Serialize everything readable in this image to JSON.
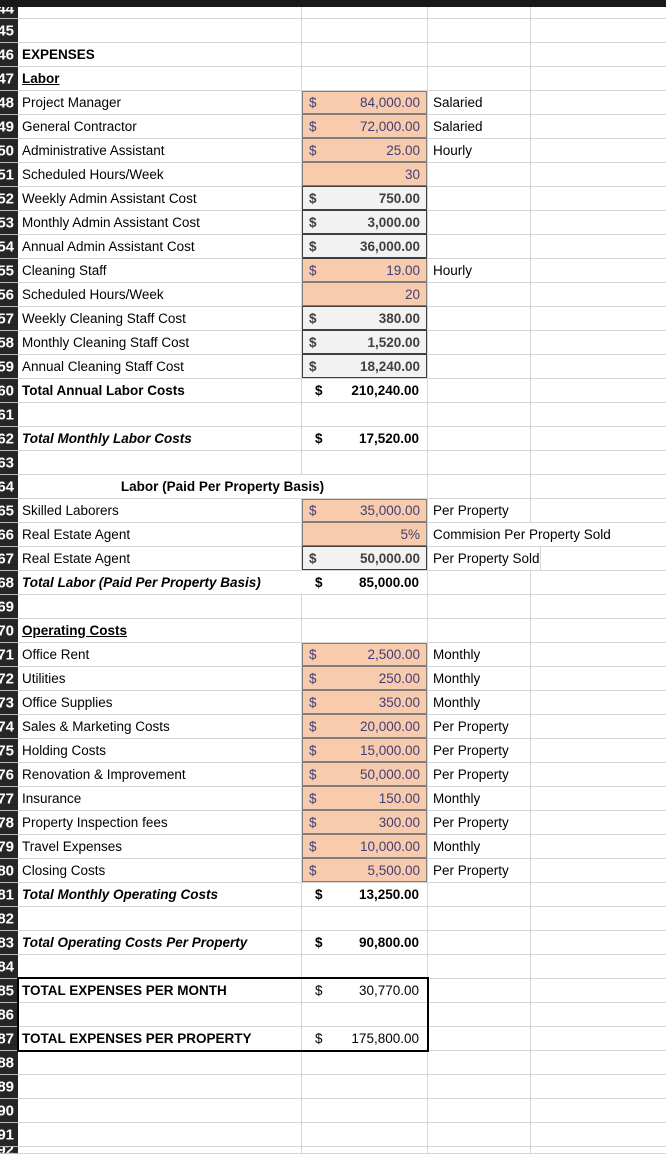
{
  "sheet": {
    "colors": {
      "input_bg": "#F8CBAD",
      "input_text": "#3F3F76",
      "input_border": "#7F7F7F",
      "output_bg": "#F2F2F2",
      "output_text": "#3F3F3F",
      "output_border": "#3F3F3F",
      "grid": "#D6D6D6",
      "header_bg": "#262626",
      "header_text": "#FFFFFF",
      "box_border": "#000000"
    },
    "rows": [
      {
        "n": 44,
        "label": ""
      },
      {
        "n": 45,
        "label": ""
      },
      {
        "n": 46,
        "label": "EXPENSES",
        "label_style": "b"
      },
      {
        "n": 47,
        "label": "Labor",
        "label_style": "bu"
      },
      {
        "n": 48,
        "label": "Project Manager",
        "value": "84,000.00",
        "dollar": "$",
        "value_style": "input",
        "unit": "Salaried"
      },
      {
        "n": 49,
        "label": "General Contractor",
        "value": "72,000.00",
        "dollar": "$",
        "value_style": "input",
        "unit": "Salaried"
      },
      {
        "n": 50,
        "label": "Administrative Assistant",
        "value": "25.00",
        "dollar": "$",
        "value_style": "input",
        "unit": "Hourly"
      },
      {
        "n": 51,
        "label": "Scheduled Hours/Week",
        "value": "30",
        "dollar": "",
        "value_style": "input"
      },
      {
        "n": 52,
        "label": "Weekly Admin Assistant Cost",
        "value": "750.00",
        "dollar": "$",
        "value_style": "output"
      },
      {
        "n": 53,
        "label": "Monthly Admin Assistant Cost",
        "value": "3,000.00",
        "dollar": "$",
        "value_style": "output"
      },
      {
        "n": 54,
        "label": "Annual Admin Assistant Cost",
        "value": "36,000.00",
        "dollar": "$",
        "value_style": "output"
      },
      {
        "n": 55,
        "label": "Cleaning Staff",
        "value": "19.00",
        "dollar": "$",
        "value_style": "input",
        "unit": "Hourly"
      },
      {
        "n": 56,
        "label": "Scheduled Hours/Week",
        "value": "20",
        "dollar": "",
        "value_style": "input"
      },
      {
        "n": 57,
        "label": "Weekly Cleaning Staff Cost",
        "value": "380.00",
        "dollar": "$",
        "value_style": "output"
      },
      {
        "n": 58,
        "label": "Monthly Cleaning Staff Cost",
        "value": "1,520.00",
        "dollar": "$",
        "value_style": "output"
      },
      {
        "n": 59,
        "label": "Annual Cleaning Staff Cost",
        "value": "18,240.00",
        "dollar": "$",
        "value_style": "output"
      },
      {
        "n": 60,
        "label": "Total Annual Labor Costs",
        "label_style": "b",
        "value": "210,240.00",
        "dollar": "$",
        "value_style": "total"
      },
      {
        "n": 61,
        "label": ""
      },
      {
        "n": 62,
        "label": "Total Monthly Labor Costs",
        "label_style": "bi",
        "value": "17,520.00",
        "dollar": "$",
        "value_style": "total"
      },
      {
        "n": 63,
        "label": ""
      },
      {
        "n": 64,
        "label": "Labor (Paid Per Property Basis)",
        "label_style": "b",
        "merge": true
      },
      {
        "n": 65,
        "label": "Skilled Laborers",
        "value": "35,000.00",
        "dollar": "$",
        "value_style": "input",
        "unit": "Per Property"
      },
      {
        "n": 66,
        "label": "Real Estate Agent",
        "value": "5%",
        "dollar": "",
        "value_style": "input",
        "unit": "Commision Per Property Sold",
        "unit_overflow": true
      },
      {
        "n": 67,
        "label": "Real Estate Agent",
        "value": "50,000.00",
        "dollar": "$",
        "value_style": "output",
        "unit": "Per Property Sold"
      },
      {
        "n": 68,
        "label": "Total  Labor (Paid Per Property Basis)",
        "label_style": "bi",
        "label_overflow": true,
        "value": "85,000.00",
        "dollar": "$",
        "value_style": "total"
      },
      {
        "n": 69,
        "label": ""
      },
      {
        "n": 70,
        "label": "Operating Costs",
        "label_style": "bu"
      },
      {
        "n": 71,
        "label": "Office Rent",
        "value": "2,500.00",
        "dollar": "$",
        "value_style": "input",
        "unit": "Monthly"
      },
      {
        "n": 72,
        "label": "Utilities",
        "value": "250.00",
        "dollar": "$",
        "value_style": "input",
        "unit": "Monthly"
      },
      {
        "n": 73,
        "label": "Office Supplies",
        "value": "350.00",
        "dollar": "$",
        "value_style": "input",
        "unit": "Monthly"
      },
      {
        "n": 74,
        "label": "Sales & Marketing Costs",
        "value": "20,000.00",
        "dollar": "$",
        "value_style": "input",
        "unit": "Per Property"
      },
      {
        "n": 75,
        "label": "Holding Costs",
        "value": "15,000.00",
        "dollar": "$",
        "value_style": "input",
        "unit": "Per Property"
      },
      {
        "n": 76,
        "label": "Renovation & Improvement",
        "value": "50,000.00",
        "dollar": "$",
        "value_style": "input",
        "unit": "Per Property"
      },
      {
        "n": 77,
        "label": "Insurance",
        "value": "150.00",
        "dollar": "$",
        "value_style": "input",
        "unit": "Monthly"
      },
      {
        "n": 78,
        "label": "Property Inspection fees",
        "value": "300.00",
        "dollar": "$",
        "value_style": "input",
        "unit": "Per Property"
      },
      {
        "n": 79,
        "label": "Travel Expenses",
        "value": "10,000.00",
        "dollar": "$",
        "value_style": "input",
        "unit": "Monthly"
      },
      {
        "n": 80,
        "label": "Closing Costs",
        "value": "5,500.00",
        "dollar": "$",
        "value_style": "input",
        "unit": "Per Property"
      },
      {
        "n": 81,
        "label": "Total Monthly Operating Costs",
        "label_style": "bi",
        "value": "13,250.00",
        "dollar": "$",
        "value_style": "total"
      },
      {
        "n": 82,
        "label": ""
      },
      {
        "n": 83,
        "label": "Total Operating Costs Per Property",
        "label_style": "bi",
        "value": "90,800.00",
        "dollar": "$",
        "value_style": "total"
      },
      {
        "n": 84,
        "label": ""
      },
      {
        "n": 85,
        "label": "TOTAL EXPENSES PER MONTH",
        "label_style": "b",
        "value": "30,770.00",
        "dollar": "$",
        "value_style": "plain"
      },
      {
        "n": 86,
        "label": ""
      },
      {
        "n": 87,
        "label": "TOTAL EXPENSES PER PROPERTY",
        "label_style": "b",
        "value": "175,800.00",
        "dollar": "$",
        "value_style": "plain"
      },
      {
        "n": 88,
        "label": ""
      },
      {
        "n": 89,
        "label": ""
      },
      {
        "n": 90,
        "label": ""
      },
      {
        "n": 91,
        "label": ""
      },
      {
        "n": 92,
        "label": ""
      }
    ]
  }
}
